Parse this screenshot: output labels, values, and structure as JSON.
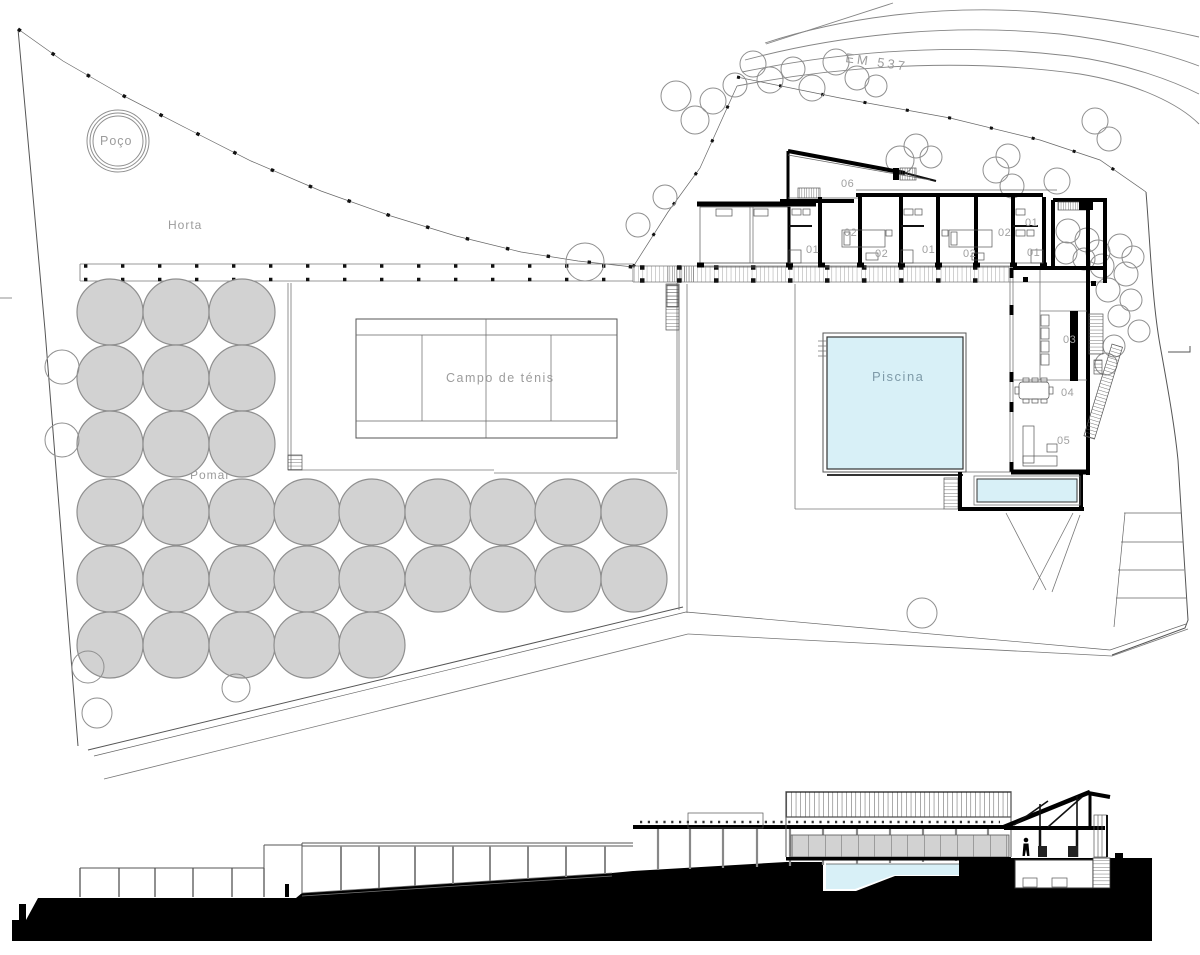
{
  "colors": {
    "paper": "#ffffff",
    "ink": "#000000",
    "label_gray": "#9c9c9c",
    "pool_fill": "#d8f0f7",
    "pool_text": "#7e9aa8",
    "tree_fill": "#d2d2d2",
    "tree_stroke": "#8f8f8f",
    "glass_gray": "#d2d2d2"
  },
  "plan": {
    "labels": {
      "well": "Poço",
      "garden": "Horta",
      "orchard": "Pomar",
      "tennis": "Campo de ténis",
      "pool": "Piscina",
      "road": "EM 537"
    },
    "room_tags": [
      {
        "label": "06",
        "x": 841,
        "y": 187
      },
      {
        "label": "02",
        "x": 844,
        "y": 236
      },
      {
        "label": "01",
        "x": 806,
        "y": 253
      },
      {
        "label": "02",
        "x": 875,
        "y": 257
      },
      {
        "label": "01",
        "x": 922,
        "y": 253
      },
      {
        "label": "02",
        "x": 963,
        "y": 257
      },
      {
        "label": "02",
        "x": 998,
        "y": 236
      },
      {
        "label": "01",
        "x": 1025,
        "y": 226
      },
      {
        "label": "01",
        "x": 1027,
        "y": 256
      },
      {
        "label": "03",
        "x": 1063,
        "y": 343
      },
      {
        "label": "04",
        "x": 1061,
        "y": 396
      },
      {
        "label": "05",
        "x": 1057,
        "y": 444
      }
    ],
    "orchard_trees": {
      "radius": 33,
      "rows": [
        {
          "y": 312,
          "xs": [
            110,
            176,
            242
          ]
        },
        {
          "y": 378,
          "xs": [
            110,
            176,
            242
          ]
        },
        {
          "y": 444,
          "xs": [
            110,
            176,
            242
          ]
        },
        {
          "y": 512,
          "xs": [
            110,
            176,
            242,
            307,
            372,
            438,
            503,
            568,
            634
          ]
        },
        {
          "y": 579,
          "xs": [
            110,
            176,
            242,
            307,
            372,
            438,
            503,
            568,
            634
          ]
        },
        {
          "y": 645,
          "xs": [
            110,
            176,
            242,
            307,
            372
          ]
        }
      ]
    },
    "outline_trees": [
      [
        62,
        367,
        17
      ],
      [
        62,
        440,
        17
      ],
      [
        88,
        667,
        16
      ],
      [
        97,
        713,
        15
      ],
      [
        236,
        688,
        14
      ],
      [
        922,
        613,
        15
      ],
      [
        585,
        262,
        19
      ],
      [
        638,
        225,
        12
      ],
      [
        665,
        197,
        12
      ],
      [
        676,
        96,
        15
      ],
      [
        695,
        120,
        14
      ],
      [
        713,
        101,
        13
      ],
      [
        735,
        85,
        12
      ],
      [
        753,
        64,
        13
      ],
      [
        770,
        80,
        13
      ],
      [
        793,
        69,
        12
      ],
      [
        812,
        88,
        13
      ],
      [
        836,
        62,
        13
      ],
      [
        857,
        78,
        12
      ],
      [
        876,
        86,
        11
      ],
      [
        900,
        160,
        14
      ],
      [
        916,
        146,
        12
      ],
      [
        931,
        157,
        11
      ],
      [
        996,
        170,
        13
      ],
      [
        1008,
        156,
        12
      ],
      [
        1012,
        186,
        12
      ],
      [
        1057,
        181,
        13
      ],
      [
        1095,
        121,
        13
      ],
      [
        1109,
        139,
        12
      ],
      [
        1120,
        246,
        12
      ],
      [
        1133,
        257,
        11
      ],
      [
        1098,
        252,
        12
      ],
      [
        1102,
        266,
        12
      ],
      [
        1126,
        274,
        12
      ],
      [
        1108,
        290,
        12
      ],
      [
        1131,
        300,
        11
      ],
      [
        1119,
        316,
        11
      ],
      [
        1139,
        331,
        11
      ],
      [
        1114,
        346,
        11
      ],
      [
        1106,
        364,
        11
      ],
      [
        1068,
        231,
        12
      ],
      [
        1087,
        240,
        12
      ],
      [
        1066,
        253,
        11
      ],
      [
        1084,
        259,
        11
      ]
    ]
  }
}
